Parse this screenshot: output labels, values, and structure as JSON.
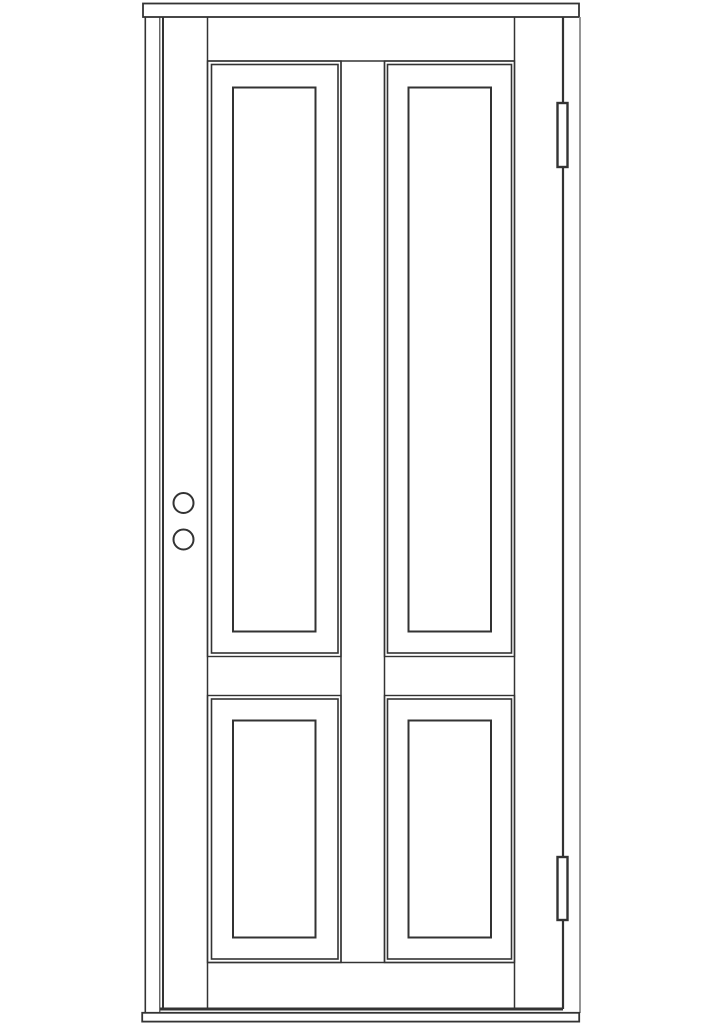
{
  "page": {
    "title": "Four-panel door front elevation - technical line drawing",
    "background": "#ffffff"
  },
  "colors": {
    "line": "#333333",
    "line_light": "#8a8a8a",
    "surface": "#ffffff"
  },
  "drawing": {
    "subject": "Four-panel exterior door with frame, front elevation, monochrome CAD line drawing",
    "frame_parts": [
      "head casing",
      "left jamb",
      "right jamb",
      "threshold sill"
    ],
    "door_parts": [
      "left stile",
      "right stile",
      "center mullion",
      "top rail",
      "lock rail",
      "bottom rail"
    ],
    "panels": [
      "upper-left",
      "upper-right",
      "lower-left",
      "lower-right"
    ],
    "hardware": [
      "top hinge",
      "bottom hinge",
      "upper bore hole",
      "lower bore hole"
    ],
    "panel_count": 4,
    "hinge_count": 2,
    "bore_hole_count": 2
  }
}
